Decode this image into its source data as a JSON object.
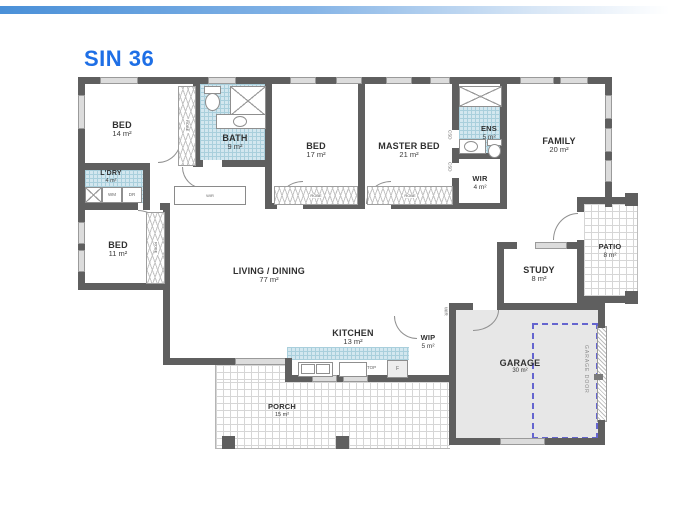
{
  "page": {
    "title": "SIN 36"
  },
  "colors": {
    "accent": "#1e6fe6",
    "wall": "#5f5f5f",
    "tile": "#d3e7ef",
    "garage_fill": "#e7e7e7",
    "car_dash": "#6565cf"
  },
  "rooms": {
    "bed1": {
      "name": "BED",
      "area": "14 m²"
    },
    "bath": {
      "name": "BATH",
      "area": "9 m²"
    },
    "bed2": {
      "name": "BED",
      "area": "17 m²"
    },
    "master": {
      "name": "MASTER BED",
      "area": "21 m²"
    },
    "ens": {
      "name": "ENS",
      "area": "5 m²"
    },
    "family": {
      "name": "FAMILY",
      "area": "20 m²"
    },
    "ldry": {
      "name": "L'DRY",
      "area": "4 m²"
    },
    "wir": {
      "name": "WIR",
      "area": "4 m²"
    },
    "bed3": {
      "name": "BED",
      "area": "11 m²"
    },
    "living": {
      "name": "LIVING / DINING",
      "area": "77 m²"
    },
    "study": {
      "name": "STUDY",
      "area": "8 m²"
    },
    "patio": {
      "name": "PATIO",
      "area": "8 m²"
    },
    "kitchen": {
      "name": "KITCHEN",
      "area": "13 m²"
    },
    "wip": {
      "name": "WIP",
      "area": "5 m²"
    },
    "garage": {
      "name": "GARAGE",
      "area": "30 m²"
    },
    "porch": {
      "name": "PORCH",
      "area": "15 m²"
    }
  },
  "labels": {
    "robe": "ROBE",
    "wir": "WIR",
    "csd": "CSD",
    "wm": "WM",
    "dr": "DR",
    "fridge": "F",
    "cooktop": "TOP",
    "garage_door": "GARAGE DOOR"
  }
}
